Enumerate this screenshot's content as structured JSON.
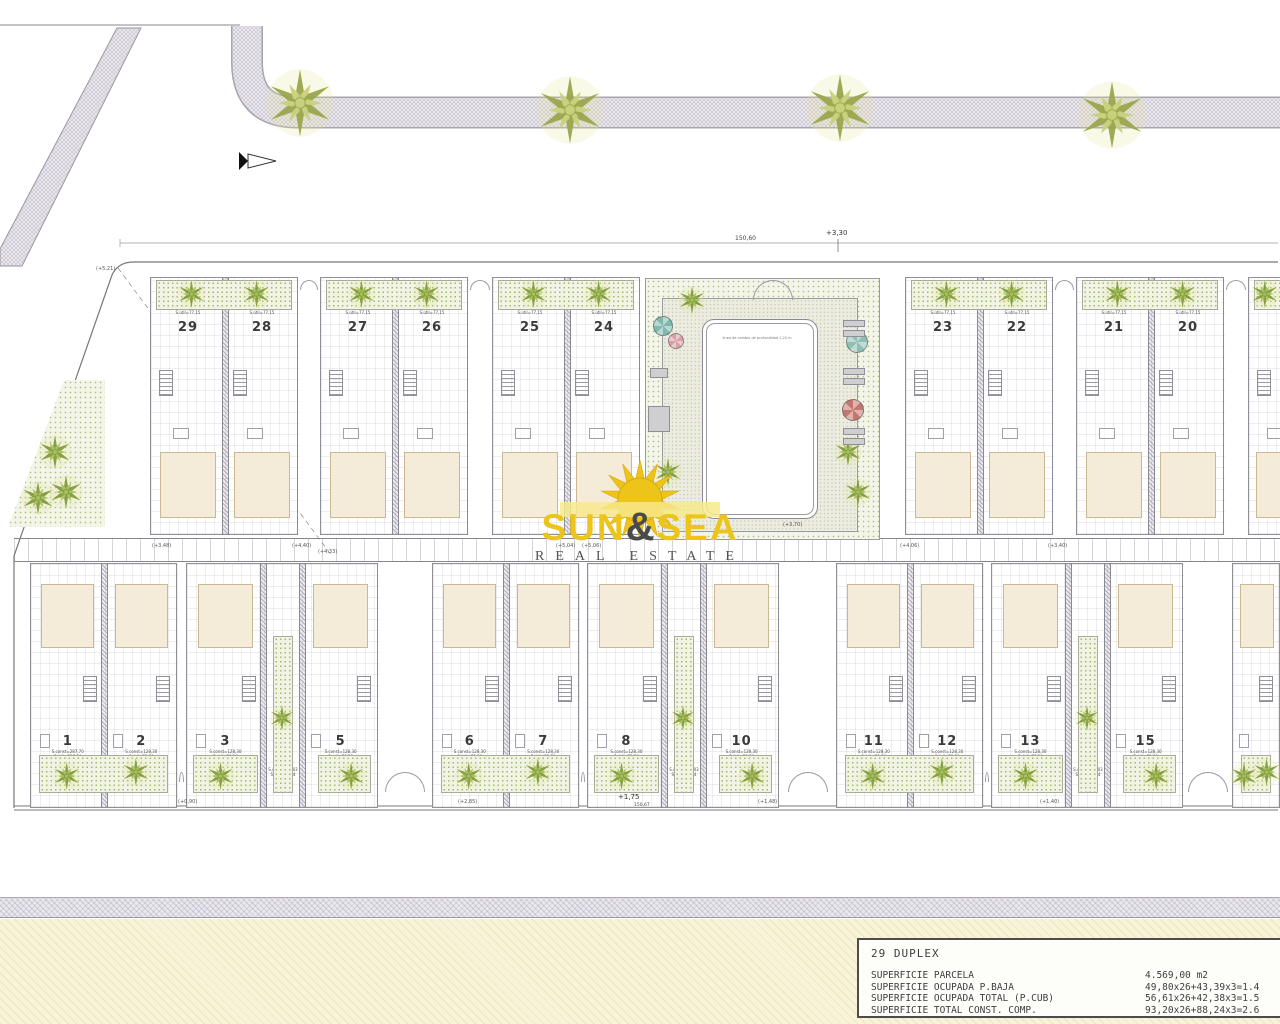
{
  "watermark": {
    "word1": "SUN",
    "amp": "&",
    "word2": "SEA",
    "subtitle": "REAL ESTATE",
    "yellow": "#ecc41a",
    "dark": "#4a4a4a"
  },
  "title_block": {
    "title": "29 DUPLEX",
    "rows": [
      {
        "label": "SUPERFICIE PARCELA",
        "value": "4.569,00 m2"
      },
      {
        "label": "SUPERFICIE OCUPADA P.BAJA",
        "value": "49,80x26+43,39x3=1.4"
      },
      {
        "label": "SUPERFICIE OCUPADA TOTAL (P.CUB)",
        "value": "56,61x26+42,38x3=1.5"
      },
      {
        "label": "SUPERFICIE TOTAL CONST. COMP.",
        "value": "93,20x26+88,24x3=2.6"
      }
    ]
  },
  "annotations": {
    "overall_dim_top": "150,60",
    "level_top": "+3,30",
    "level_bottom": "+1,75",
    "overall_dim_bottom": "150,67",
    "pool_note": "línea de cambio de profundidad 1,20 m",
    "deck_level": "(+3,70)",
    "misc_levels": [
      {
        "t": "(+5,21)",
        "x": 96,
        "y": 266
      },
      {
        "t": "(+3,48)",
        "x": 152,
        "y": 543
      },
      {
        "t": "(+4,33)",
        "x": 318,
        "y": 549
      },
      {
        "t": "(+4,40)",
        "x": 292,
        "y": 543
      },
      {
        "t": "(+5,04)",
        "x": 556,
        "y": 543
      },
      {
        "t": "(+5,06)",
        "x": 582,
        "y": 543
      },
      {
        "t": "(+4,06)",
        "x": 900,
        "y": 543
      },
      {
        "t": "(+3,40)",
        "x": 1048,
        "y": 543
      },
      {
        "t": "(+0,90)",
        "x": 178,
        "y": 799
      },
      {
        "t": "(+2,85)",
        "x": 458,
        "y": 799
      },
      {
        "t": "(+1,48)",
        "x": 758,
        "y": 799
      },
      {
        "t": "(+1,40)",
        "x": 1040,
        "y": 799
      }
    ]
  },
  "plan": {
    "street_trees": [
      {
        "x": 300,
        "y": 103
      },
      {
        "x": 570,
        "y": 110
      },
      {
        "x": 840,
        "y": 108
      },
      {
        "x": 1112,
        "y": 115
      }
    ],
    "triangle_palms": [
      {
        "x": 55,
        "y": 452
      },
      {
        "x": 38,
        "y": 498
      },
      {
        "x": 66,
        "y": 492
      }
    ],
    "top_groups": [
      {
        "x": 150,
        "w": 148,
        "units": [
          "29",
          "28"
        ]
      },
      {
        "x": 320,
        "w": 148,
        "units": [
          "27",
          "26"
        ]
      },
      {
        "x": 492,
        "w": 148,
        "units": [
          "25",
          "24"
        ]
      },
      {
        "x": 905,
        "w": 148,
        "units": [
          "23",
          "22"
        ]
      },
      {
        "x": 1076,
        "w": 148,
        "units": [
          "21",
          "20"
        ]
      },
      {
        "x": 1248,
        "w": 60,
        "units": [
          ""
        ]
      }
    ],
    "bottom_groups": [
      {
        "x": 30,
        "w": 147,
        "units": [
          "1",
          "2"
        ],
        "type": "pair"
      },
      {
        "x": 186,
        "w": 192,
        "units": [
          "3",
          "4",
          "5"
        ],
        "type": "triple"
      },
      {
        "x": 432,
        "w": 147,
        "units": [
          "6",
          "7"
        ],
        "type": "pair"
      },
      {
        "x": 587,
        "w": 192,
        "units": [
          "8",
          "9",
          "10"
        ],
        "type": "triple"
      },
      {
        "x": 836,
        "w": 147,
        "units": [
          "11",
          "12"
        ],
        "type": "pair"
      },
      {
        "x": 991,
        "w": 192,
        "units": [
          "13",
          "14",
          "15"
        ],
        "type": "triple"
      },
      {
        "x": 1232,
        "w": 48,
        "units": [
          ""
        ],
        "type": "partial"
      }
    ],
    "unit_area_text": {
      "top": [
        "S.const=139,85",
        "S.útil=77,15"
      ],
      "bottom": [
        "S.const=128,30",
        "S.útil=79,30"
      ],
      "corner": [
        "S.const=88,03",
        "S.útil=62,84"
      ]
    },
    "unit_area_overrides": {
      "1": [
        "S.const=287,70",
        "S.útil=237,80"
      ]
    },
    "pool_items": [
      {
        "type": "umbrella",
        "color": "#7fb8ad",
        "x": 663,
        "y": 326,
        "r": 10
      },
      {
        "type": "umbrella",
        "color": "#d9a0a8",
        "x": 676,
        "y": 341,
        "r": 8
      },
      {
        "type": "umbrella",
        "color": "#8fbfb2",
        "x": 857,
        "y": 342,
        "r": 11
      },
      {
        "type": "umbrella",
        "color": "#c4766f",
        "x": 853,
        "y": 410,
        "r": 11
      },
      {
        "type": "palm",
        "x": 848,
        "y": 452
      },
      {
        "type": "palm",
        "x": 858,
        "y": 492
      },
      {
        "type": "palm",
        "x": 668,
        "y": 472
      },
      {
        "type": "palm",
        "x": 692,
        "y": 300
      }
    ],
    "sunbeds": [
      {
        "x": 843,
        "y": 320,
        "w": 22,
        "h": 7
      },
      {
        "x": 843,
        "y": 330,
        "w": 22,
        "h": 7
      },
      {
        "x": 843,
        "y": 368,
        "w": 22,
        "h": 7
      },
      {
        "x": 843,
        "y": 378,
        "w": 22,
        "h": 7
      },
      {
        "x": 843,
        "y": 428,
        "w": 22,
        "h": 7
      },
      {
        "x": 843,
        "y": 438,
        "w": 22,
        "h": 7
      },
      {
        "x": 650,
        "y": 368,
        "w": 18,
        "h": 10
      },
      {
        "x": 648,
        "y": 406,
        "w": 22,
        "h": 26
      }
    ]
  }
}
